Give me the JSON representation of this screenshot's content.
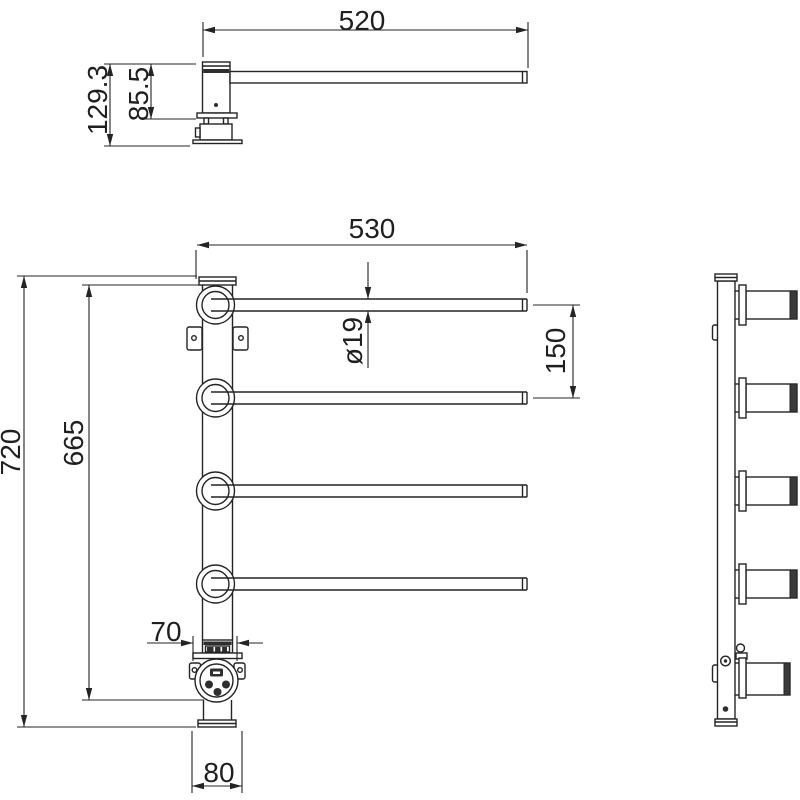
{
  "colors": {
    "background": "#ffffff",
    "line": "#242424",
    "dark_fill": "#2e2e2e"
  },
  "views": {
    "top_view": {
      "name": "single-arm-side-elevation"
    },
    "front_view": {
      "name": "front-elevation"
    },
    "side_view": {
      "name": "side-profile"
    }
  },
  "dimensions": {
    "arm_length": {
      "label": "520"
    },
    "arm_total_height": {
      "label": "129.3"
    },
    "arm_body_height": {
      "label": "85.5"
    },
    "bar_length": {
      "label": "530"
    },
    "bar_diameter": {
      "label": "ø19"
    },
    "bar_spacing": {
      "label": "150"
    },
    "overall_height": {
      "label": "720"
    },
    "inner_height": {
      "label": "665"
    },
    "connector_width": {
      "label": "70"
    },
    "base_width": {
      "label": "80"
    }
  }
}
